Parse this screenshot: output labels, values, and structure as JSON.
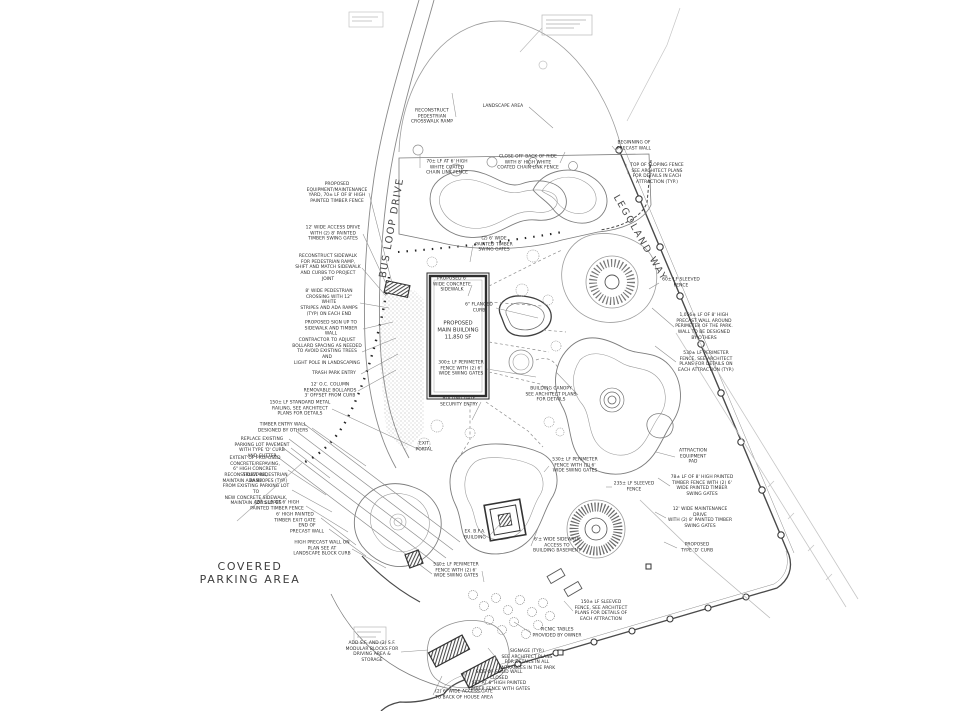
{
  "drawing": {
    "street_labels": {
      "bus_loop": "BUS LOOP DRIVE",
      "legoland_way": "LEGOLAND WAY",
      "parking": "COVERED\nPARKING AREA"
    },
    "building_label": "PROPOSED\nMAIN BUILDING\n11,850 SF",
    "ink_color": "#4a4a4a",
    "callouts": [
      {
        "text": "PROPOSED\nEQUIPMENT/MAINTENANCE\nYARD, 70± LF OF 8' HIGH\nPAINTED TIMBER FENCE",
        "x": 337,
        "y": 193,
        "w": 64,
        "lx": 392,
        "ly": 283
      },
      {
        "text": "12' WIDE ACCESS DRIVE\nWITH (2) 8' PAINTED\nTIMBER SWING GATES",
        "x": 333,
        "y": 234,
        "w": 60,
        "lx": 390,
        "ly": 292
      },
      {
        "text": "RECONSTRUCT SIDEWALK\nFOR PEDESTRIAN RAMP,\nSHIFT AND MATCH SIDEWALK\nAND CURBS TO PROJECT JOINT",
        "x": 328,
        "y": 268,
        "w": 68,
        "lx": 386,
        "ly": 296
      },
      {
        "text": "8' WIDE PEDESTRIAN\nCROSSING WITH 12\" WHITE\nSTRIPES AND ADA RAMPS\n(TYP) ON EACH END",
        "x": 329,
        "y": 303,
        "w": 62,
        "lx": 389,
        "ly": 308
      },
      {
        "text": "PROPOSED SIGN UP TO\nSIDEWALK AND TIMBER WALL",
        "x": 331,
        "y": 329,
        "w": 64,
        "lx": 393,
        "ly": 322
      },
      {
        "text": "CONTRACTOR TO ADJUST\nBOLLARD SPACING AS NEEDED\nTO AVOID EXISTING TREES AND\nLIGHT POLE IN LANDSCAPING",
        "x": 327,
        "y": 352,
        "w": 70,
        "lx": 396,
        "ly": 338
      },
      {
        "text": "TRASH PARK ENTRY",
        "x": 334,
        "y": 374,
        "w": 54,
        "lx": 398,
        "ly": 354
      },
      {
        "text": "12' O.C. COLUMN\nREMOVABLE BOLLARDS\n3' OFFSET FROM CURB",
        "x": 330,
        "y": 391,
        "w": 56,
        "lx": 396,
        "ly": 370
      },
      {
        "text": "150± LF STANDARD METAL\nRAILING, SEE ARCHITECT\nPLANS FOR DETAILS",
        "x": 300,
        "y": 409,
        "w": 64,
        "lx": 420,
        "ly": 450
      },
      {
        "text": "TIMBER ENTRY WALL\nDESIGNED BY OTHERS",
        "x": 283,
        "y": 428,
        "w": 58,
        "lx": 366,
        "ly": 466
      },
      {
        "text": "REPLACE EXISTING\nPARKING LOT PAVEMENT\nWITH TYPE 'D' CURB\nAND GUTTER",
        "x": 262,
        "y": 448,
        "w": 58,
        "lx": 330,
        "ly": 478
      },
      {
        "text": "EXTENT OF PROPOSED\nCONCRETE/REPAVING,\n6\" HIGH CONCRETE SIDEWALK,\nMAINTAIN ADA SLOPES (TYP.)",
        "x": 255,
        "y": 470,
        "w": 66,
        "lx": 326,
        "ly": 495
      },
      {
        "text": "RECONSTRUCT PEDESTRIAN RAMP\nFROM EXISTING PARKING LOT TO\nNEW CONCRETE SIDEWALK,\nMAINTAIN ADA SLOPES",
        "x": 256,
        "y": 490,
        "w": 72,
        "lx": 332,
        "ly": 512
      },
      {
        "text": "150± LF OF 6' HIGH\nPAINTED TIMBER FENCE",
        "x": 277,
        "y": 506,
        "w": 58,
        "lx": 348,
        "ly": 532
      },
      {
        "text": "6' HIGH PAINTED\nTIMBER EXIT GATE",
        "x": 295,
        "y": 518,
        "w": 52,
        "lx": 356,
        "ly": 545
      },
      {
        "text": "END OF\nPRECAST WALL",
        "x": 307,
        "y": 529,
        "w": 44,
        "lx": 366,
        "ly": 556
      },
      {
        "text": "HIGH PRECAST WALL ON\nPLAN SEE AT\nLANDSCAPE BLOCK CURB",
        "x": 322,
        "y": 549,
        "w": 60,
        "lx": 386,
        "ly": 568
      },
      {
        "text": "RECONSTRUCT\nPEDESTRIAN\nCROSSWALK RAMP",
        "x": 432,
        "y": 117,
        "w": 48,
        "lx": 452,
        "ly": 93
      },
      {
        "text": "LANDSCAPE AREA",
        "x": 503,
        "y": 107,
        "w": 52,
        "lx": 553,
        "ly": 128
      },
      {
        "text": "70± LF AT 6' HIGH\nWHITE COATED\nCHAIN LINK FENCE",
        "x": 447,
        "y": 168,
        "w": 54,
        "lx": 420,
        "ly": 155
      },
      {
        "text": "CLOSE OFF BACK OF RIDE\nWITH 8' HIGH WHITE\nCOATED CHAIN LINK FENCE",
        "x": 528,
        "y": 163,
        "w": 64,
        "lx": 565,
        "ly": 152
      },
      {
        "text": "BEGINNING OF\nPRECAST WALL",
        "x": 634,
        "y": 146,
        "w": 44,
        "lx": 617,
        "ly": 152
      },
      {
        "text": "TOP OF SLOPING FENCE\nSEE ARCHITECT PLANS\nFOR DETAILS IN EACH\nATTRACTION (TYP.)",
        "x": 657,
        "y": 174,
        "w": 58,
        "lx": 626,
        "ly": 164
      },
      {
        "text": "1,056± LF OF 8' HIGH\nPRECAST WALL AROUND\nPERIMETER OF THE PARK.\nWALL TO BE DESIGNED\nBY OTHERS",
        "x": 704,
        "y": 327,
        "w": 60,
        "lx": 652,
        "ly": 308
      },
      {
        "text": "530± LF PERIMETER\nFENCE, SEE ARCHITECT\nPLANS FOR DETAILS ON\nEACH ATTRACTION (TYP.)",
        "x": 706,
        "y": 362,
        "w": 60,
        "lx": 655,
        "ly": 346
      },
      {
        "text": "60± LF SLEEVED\nFENCE",
        "x": 681,
        "y": 283,
        "w": 44,
        "lx": 649,
        "ly": 289
      },
      {
        "text": "ATTRACTION\nEQUIPMENT\nPAD",
        "x": 693,
        "y": 457,
        "w": 36,
        "lx": 656,
        "ly": 452
      },
      {
        "text": "78± LF OF 8' HIGH PAINTED\nTIMBER FENCE WITH (2) 6'\nWIDE PAINTED TIMBER\nSWING GATES",
        "x": 702,
        "y": 486,
        "w": 64,
        "lx": 658,
        "ly": 478
      },
      {
        "text": "12' WIDE MAINTENANCE DRIVE\nWITH (2) 8' PAINTED TIMBER\nSWING GATES",
        "x": 700,
        "y": 518,
        "w": 68,
        "lx": 655,
        "ly": 512
      },
      {
        "text": "PROPOSED\nTYPE 'D' CURB",
        "x": 697,
        "y": 548,
        "w": 40,
        "lx": 664,
        "ly": 542
      },
      {
        "text": "(2) 6' WIDE\nPAINTED TIMBER\nSWING GATES",
        "x": 494,
        "y": 245,
        "w": 42,
        "lx": 470,
        "ly": 262
      },
      {
        "text": "PROPOSED 6'\nWIDE CONCRETE\nSIDEWALK",
        "x": 452,
        "y": 285,
        "w": 40,
        "lx": 468,
        "ly": 296
      },
      {
        "text": "6\" FLANGED\nCURB",
        "x": 479,
        "y": 308,
        "w": 34,
        "lx": 538,
        "ly": 318
      },
      {
        "text": "300± LF PERIMETER\nFENCE WITH (2) 6'\nWIDE SWING GATES",
        "x": 461,
        "y": 369,
        "w": 52,
        "lx": 536,
        "ly": 377
      },
      {
        "text": "ROLLING GATE\nSECURITY ENTRY",
        "x": 459,
        "y": 402,
        "w": 44,
        "lx": 472,
        "ly": 420
      },
      {
        "text": "BUILDING CANOPY\nSEE ARCHITECT PLANS\nFOR DETAILS",
        "x": 551,
        "y": 395,
        "w": 54,
        "lx": 556,
        "ly": 372
      },
      {
        "text": "EXIT\nPORTAL",
        "x": 424,
        "y": 447,
        "w": 24
      },
      {
        "text": "530± LF PERIMETER\nFENCE WITH (2) 6'\nWIDE SWING GATES",
        "x": 575,
        "y": 466,
        "w": 52,
        "lx": 544,
        "ly": 472
      },
      {
        "text": "235± LF SLEEVED\nFENCE",
        "x": 634,
        "y": 487,
        "w": 44,
        "lx": 606,
        "ly": 487
      },
      {
        "text": "EX. B.F.A.\nBUILDING",
        "x": 475,
        "y": 535,
        "w": 30,
        "lx": 502,
        "ly": 522
      },
      {
        "text": "6'± WIDE SIDEWALK\nACCESS TO\nBUILDING BASEMENT",
        "x": 557,
        "y": 546,
        "w": 52,
        "lx": 538,
        "ly": 528
      },
      {
        "text": "530± LF PERIMETER\nFENCE WITH (2) 6'\nWIDE SWING GATES",
        "x": 456,
        "y": 571,
        "w": 52,
        "lx": 484,
        "ly": 582
      },
      {
        "text": "150± LF SLEEVED\nFENCE, SEE ARCHITECT\nPLANS FOR DETAILS OF\nEACH ATTRACTION",
        "x": 601,
        "y": 611,
        "w": 56,
        "lx": 564,
        "ly": 601
      },
      {
        "text": "PICNIC TABLES\nPROVIDED BY OWNER",
        "x": 557,
        "y": 633,
        "w": 52,
        "lx": 514,
        "ly": 622
      },
      {
        "text": "SIGNAGE (TYP.)\nSEE ARCHITECT PLANS\nFOR DETAILS IN ALL\nENTRANCES IN THE PARK",
        "x": 527,
        "y": 660,
        "w": 58,
        "lx": 488,
        "ly": 648
      },
      {
        "text": "SIDE OF SOLID WALL CLOSED\nSET AT 6' HIGH PAINTED\nTIMBER FENCE WITH GATES",
        "x": 499,
        "y": 681,
        "w": 66,
        "lx": 464,
        "ly": 671
      },
      {
        "text": "(2) 6' WIDE ACCESS GATE\nTO BACK OF HOUSE AREA",
        "x": 464,
        "y": 695,
        "w": 62,
        "lx": 442,
        "ly": 676
      },
      {
        "text": "ADD S.F. AND (2) S.F.\nMODULAR BLOCKS FOR\nDRIVING AREA & STORAGE",
        "x": 372,
        "y": 652,
        "w": 58,
        "lx": 428,
        "ly": 650
      }
    ]
  }
}
